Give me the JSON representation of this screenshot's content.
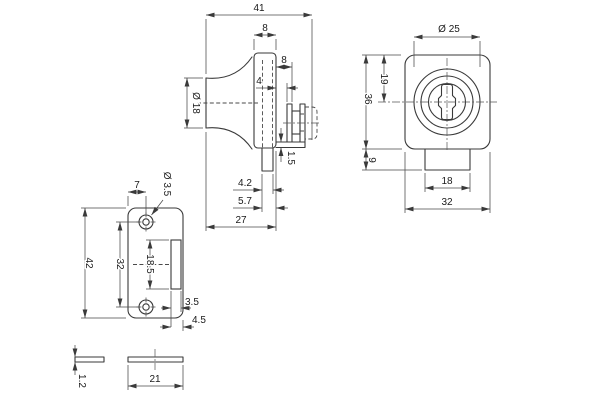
{
  "drawing": {
    "colors": {
      "line": "#3a3a3a",
      "background": "#ffffff"
    },
    "dims": {
      "side": {
        "overall": "41",
        "body_thk": "8",
        "clamp_w": "8",
        "glass_gap": "4",
        "knob_dia": "Ø 18",
        "pad_thk": "1.5",
        "bolt_dia": "4.2",
        "bolt_off": "5.7",
        "depth": "27"
      },
      "front": {
        "cyl_dia": "Ø 25",
        "cyl_center": "19",
        "body_h": "36",
        "tab_h": "9",
        "tab_w": "18",
        "body_w": "32"
      },
      "plate": {
        "hole_off": "7",
        "hole_dia": "Ø 3.5",
        "height": "42",
        "hole_span": "32",
        "slot_len": "18.5",
        "slot_w": "3.5",
        "slot_edge": "4.5"
      },
      "edge": {
        "thickness": "1.2",
        "width": "21"
      }
    }
  }
}
